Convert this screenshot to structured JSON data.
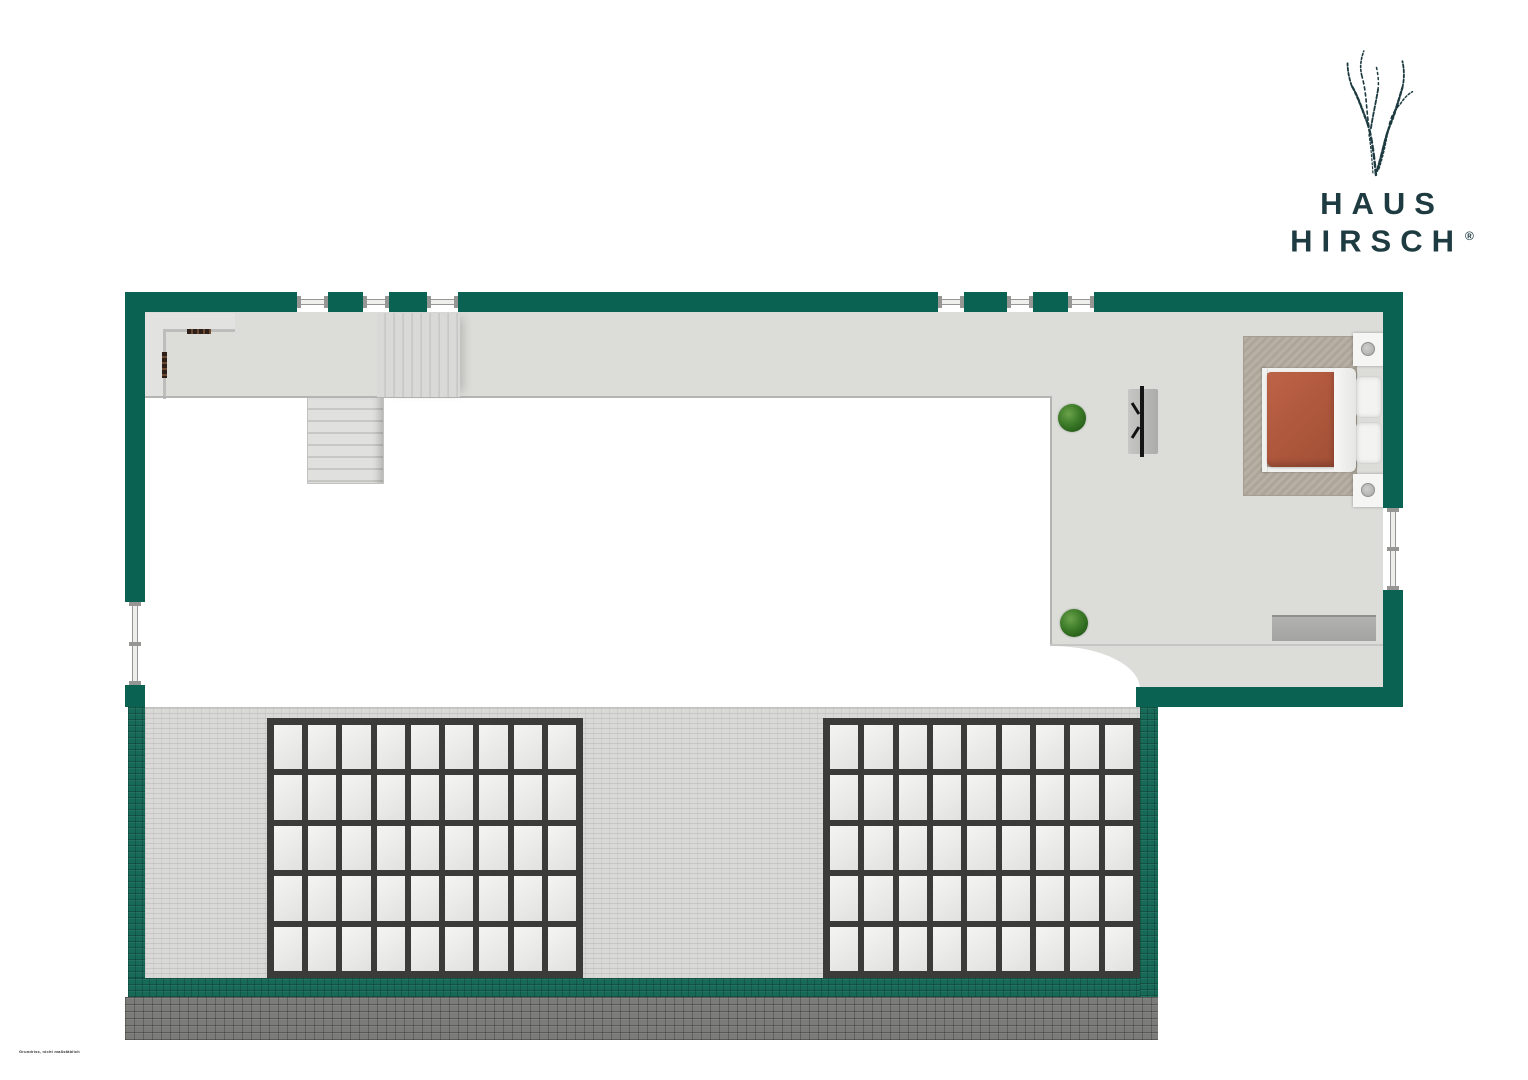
{
  "brand": {
    "name_line1": "HAUS",
    "name_line2": "HIRSCH",
    "registered_mark": "®"
  },
  "footer": {
    "disclaimer": "Grundriss, nicht maßstäblich"
  },
  "palette": {
    "wall_green": "#0a6253",
    "roof_band_green": "#186a58",
    "floor_gray": "#dcddd9",
    "roof_gray": "#d9d9d7",
    "eave_gray": "#7b7b79",
    "skylight_frame": "#3b3b39",
    "skylight_panel": "#efefed",
    "rug_taupe": "#b2aa9d",
    "duvet_terracotta": "#b1593e",
    "logo_ink": "#1d3b40"
  },
  "floorplan": {
    "top_windows": [
      {
        "x": 297,
        "w": 31
      },
      {
        "x": 363,
        "w": 26
      },
      {
        "x": 427,
        "w": 31
      },
      {
        "x": 938,
        "w": 26
      },
      {
        "x": 1007,
        "w": 26
      },
      {
        "x": 1068,
        "w": 26
      }
    ],
    "left_window": {
      "y": 602,
      "h": 83
    },
    "right_window": {
      "y": 508,
      "h": 82
    },
    "skylight_grids": [
      {
        "name": "skylight-grid-left",
        "x": 267,
        "y": 718,
        "w": 316,
        "h": 260,
        "rows": 5,
        "cols": 9
      },
      {
        "name": "skylight-grid-right",
        "x": 823,
        "y": 718,
        "w": 317,
        "h": 260,
        "rows": 5,
        "cols": 9
      }
    ],
    "furniture": [
      "double-bed",
      "nightstand-top",
      "nightstand-bottom",
      "rug",
      "dresser",
      "tv-unit",
      "plant",
      "plant",
      "staircase-upper",
      "staircase-lower"
    ]
  }
}
